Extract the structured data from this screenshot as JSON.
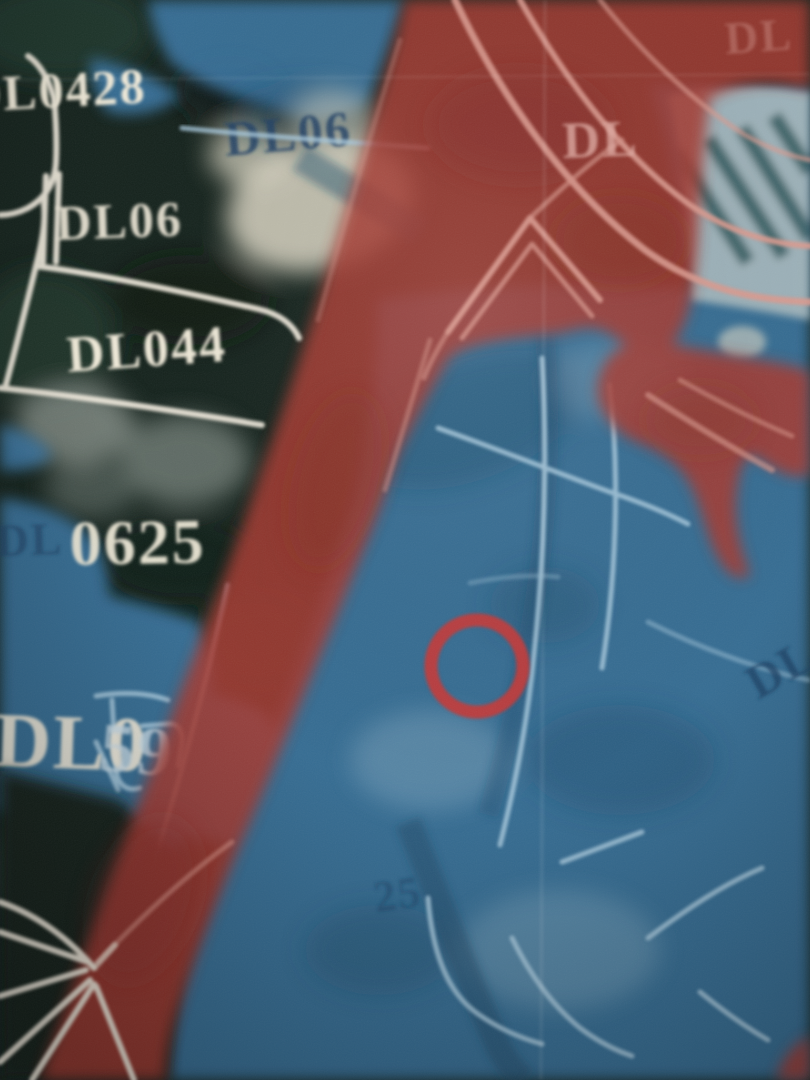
{
  "map": {
    "labels": {
      "dl0428": "DL0428",
      "dl06_blue": "DL06",
      "dl06_white": "DL06",
      "dl044": "DL044",
      "dl0625_prefix": "DL",
      "dl0625_digits": "0625",
      "dl059_prefix": "DL0",
      "dl059_suffix": "59",
      "dl_under_red": "DL",
      "dl_top_right": "DL",
      "dl_right_edge": "DL",
      "faint_25": "25"
    },
    "marker": {
      "name": "red-circle-marker",
      "shape": "circle"
    }
  },
  "colors": {
    "photo_dark": "#15231d",
    "photo_green": "#223c2e",
    "photo_gray": "#87908a",
    "building_cream": "#ddd8c6",
    "slat_green": "#2c4a3c",
    "blue_overlay": "#3c7cab",
    "blue_deep": "#1d4968",
    "parcel_blue": "#a9cade",
    "red_overlay": "#a53a30",
    "red_deep": "#7e2a24",
    "pink_line": "#dc9b90",
    "parcel_white": "#efe9dc",
    "label_white": "#f0ead9",
    "label_navy": "#1d4166",
    "label_pink": "#e2aca3",
    "label_bluetint": "#c8dbe6",
    "marker_red": "#c13b3a"
  }
}
